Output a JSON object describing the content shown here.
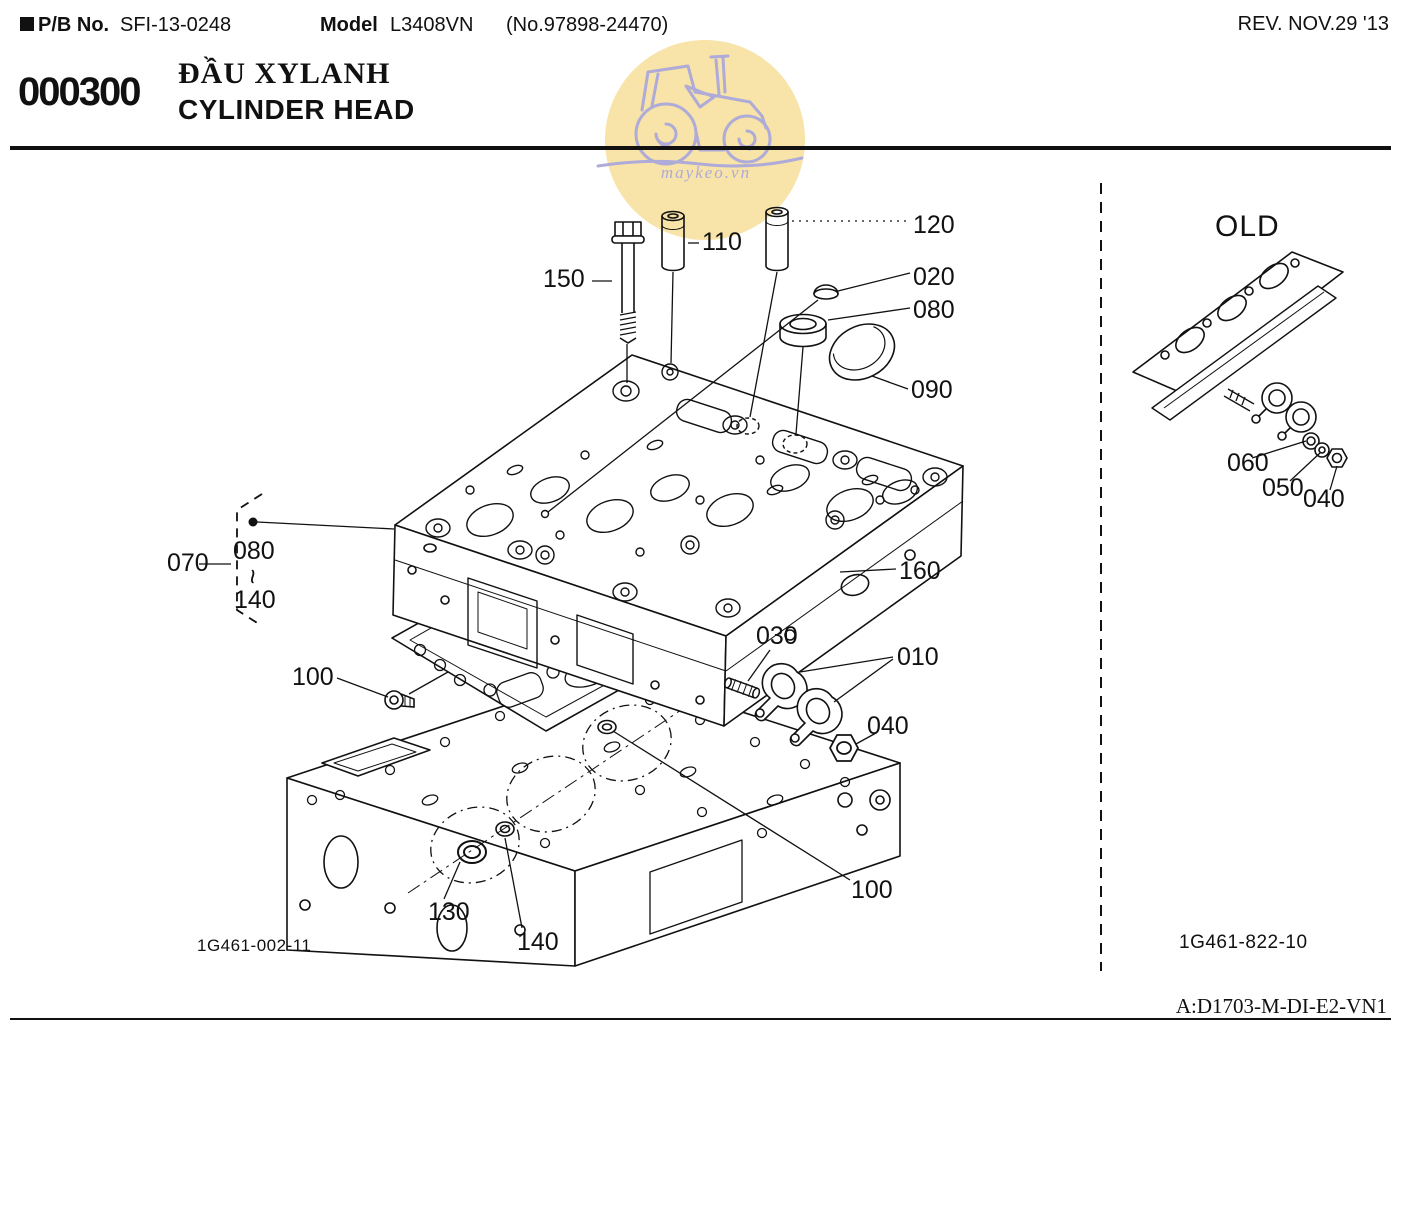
{
  "header": {
    "pb_label": "P/B No.",
    "pb_value": "SFI-13-0248",
    "model_label": "Model",
    "model_value": "L3408VN",
    "ref_no": "(No.97898-24470)",
    "revision": "REV. NOV.29 '13"
  },
  "section": {
    "code": "000300",
    "title_vietnamese": "ĐẦU XYLANH",
    "title_english": "CYLINDER HEAD"
  },
  "watermark": {
    "text": "maykeo.vn",
    "icon": "tractor-icon",
    "circle_color": "#f8e3a8",
    "stroke_color": "#aeabd9"
  },
  "main_figure": {
    "figure_code": "1G461-002-11",
    "part_labels": [
      {
        "ref": "120"
      },
      {
        "ref": "110"
      },
      {
        "ref": "150"
      },
      {
        "ref": "020"
      },
      {
        "ref": "080"
      },
      {
        "ref": "090"
      },
      {
        "ref": "070"
      },
      {
        "ref": "080"
      },
      {
        "ref": "~"
      },
      {
        "ref": "140"
      },
      {
        "ref": "160"
      },
      {
        "ref": "030"
      },
      {
        "ref": "010"
      },
      {
        "ref": "100"
      },
      {
        "ref": "040"
      },
      {
        "ref": "100"
      },
      {
        "ref": "130"
      },
      {
        "ref": "140"
      }
    ]
  },
  "old_panel": {
    "title": "OLD",
    "figure_code": "1G461-822-10",
    "part_labels": [
      {
        "ref": "060"
      },
      {
        "ref": "050"
      },
      {
        "ref": "040"
      }
    ]
  },
  "footer": {
    "doc_code": "A:D1703-M-DI-E2-VN1"
  }
}
